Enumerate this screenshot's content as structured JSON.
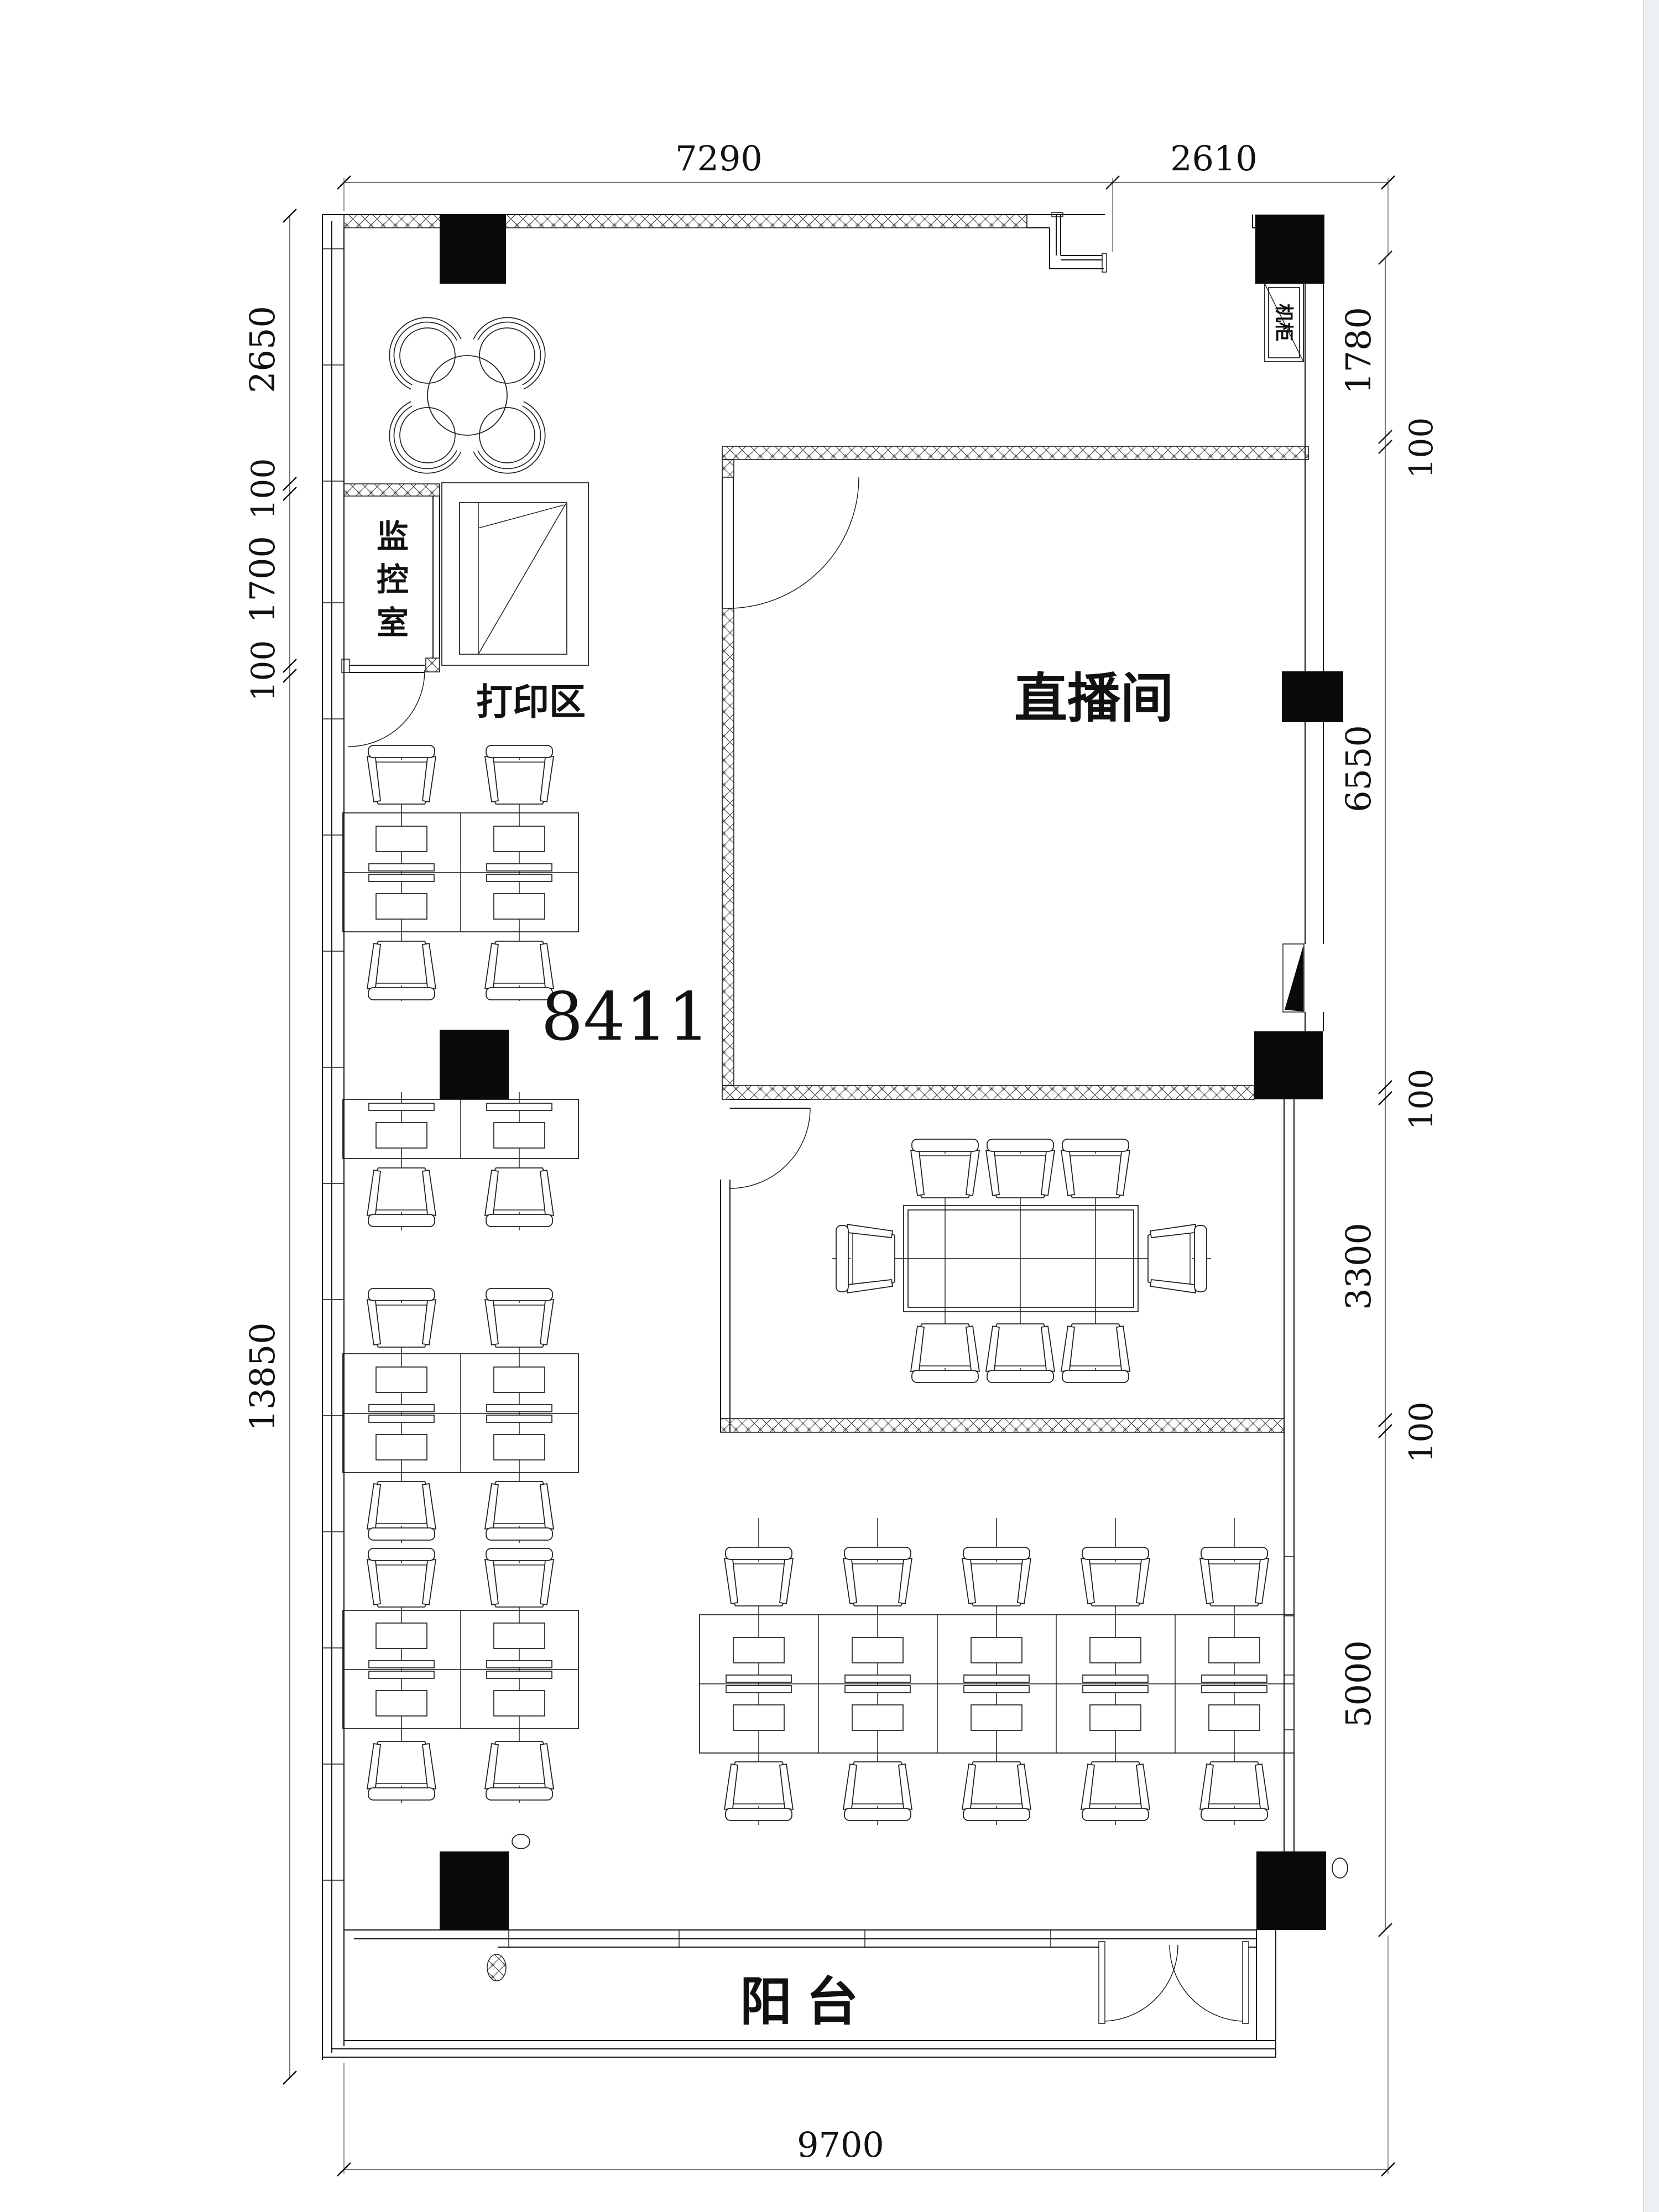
{
  "unit_label": "8411",
  "rooms": {
    "monitor_room": {
      "chars": [
        "监",
        "控",
        "室"
      ]
    },
    "print_area": "打印区",
    "live_room": "直播间",
    "cabinet": "机柜",
    "balcony": "阳  台"
  },
  "dimensions": {
    "top": [
      "7290",
      "2610"
    ],
    "left": [
      "2650",
      "100",
      "1700",
      "100",
      "13850"
    ],
    "right": [
      "1780",
      "100",
      "6550",
      "100",
      "3300",
      "100",
      "5000"
    ],
    "bottom": [
      "9700"
    ]
  },
  "colors": {
    "line": "#161616",
    "column_fill": "#0a0a0a",
    "background": "#ffffff"
  }
}
